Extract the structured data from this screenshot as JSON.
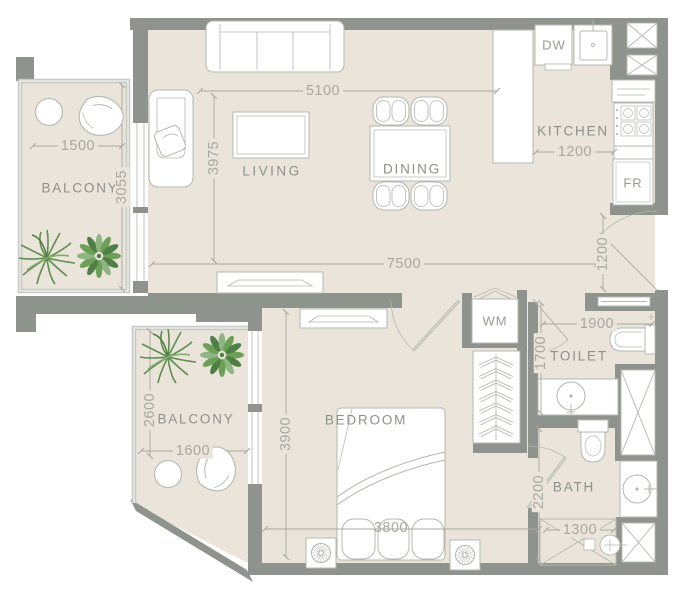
{
  "rooms": {
    "living": "LIVING",
    "dining": "DINING",
    "kitchen": "KITCHEN",
    "bedroom": "BEDROOM",
    "toilet": "TOILET",
    "bath": "BATH",
    "balcony_upper": "BALCONY",
    "balcony_lower": "BALCONY"
  },
  "appliances": {
    "dishwasher": "DW",
    "fridge": "FR",
    "washer": "WM"
  },
  "dimensions_mm": {
    "living_width": "5100",
    "living_depth": "3975",
    "balcony_upper_width": "1500",
    "balcony_upper_depth": "3055",
    "kitchen_aisle": "1200",
    "overall_width": "7500",
    "entry_door": "1200",
    "toilet_width": "1900",
    "toilet_depth": "1700",
    "bath_depth": "2200",
    "shower_width": "1300",
    "balcony_lower_depth": "2600",
    "balcony_lower_width": "1600",
    "bedroom_depth": "3900",
    "bedroom_width": "3800"
  },
  "colors": {
    "wall": "#8e938e",
    "floor": "#eae4db",
    "railing": "#c6cac3",
    "furniture_line": "#b4b8b0",
    "dimension": "#a8a8a0",
    "label": "#8c9189",
    "plant_dark": "#4f7f44",
    "plant_mid": "#6da057",
    "plant_light": "#8fb582"
  }
}
